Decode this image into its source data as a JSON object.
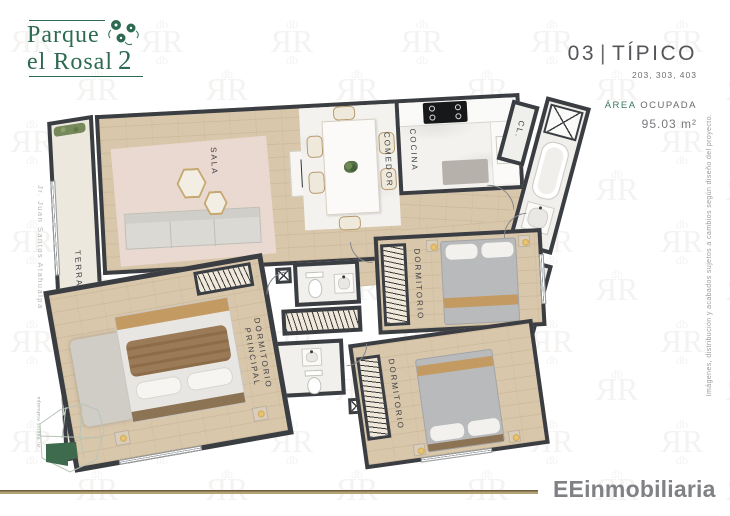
{
  "logo": {
    "line1": "Parque",
    "line2": "el Rosal",
    "number": "2"
  },
  "header": {
    "unit_number": "03",
    "separator": "|",
    "unit_type": "TÍPICO",
    "unit_list": "203, 303, 403",
    "area_label_accent": "ÁREA",
    "area_label_rest": "OCUPADA",
    "area_value": "95.03 m²"
  },
  "plan": {
    "type": "floor_plan",
    "rooms": {
      "terraza": {
        "label": "TERRAZA"
      },
      "sala": {
        "label": "SALA"
      },
      "comedor": {
        "label": "COMEDOR"
      },
      "cocina": {
        "label": "COCINA"
      },
      "closet": {
        "label": "CL."
      },
      "laundry": {
        "label": "LAV."
      },
      "dormitorio_principal": {
        "line1": "DORMITORIO",
        "line2": "PRINCIPAL"
      },
      "dormitorio_1": {
        "label": "DORMITORIO"
      },
      "dormitorio_2": {
        "label": "DORMITORIO"
      }
    }
  },
  "sides": {
    "left_street": "Jr. Juan Santos Atahualpa",
    "right_disclaimer": "Imágenes, distribución y acabados sujetos a cambios según diseño del proyecto."
  },
  "site_map": {
    "street": "Jr. Santos Atahualpa"
  },
  "footer": {
    "brand": "EEinmobiliaria"
  },
  "colors": {
    "brand_green": "#2e6a51",
    "accent_green": "#37785c",
    "gold_line": "#9c8a5e",
    "wall": "#3a3d41",
    "wood_floor": "#d9c7ab",
    "title_gray": "#55565a"
  }
}
